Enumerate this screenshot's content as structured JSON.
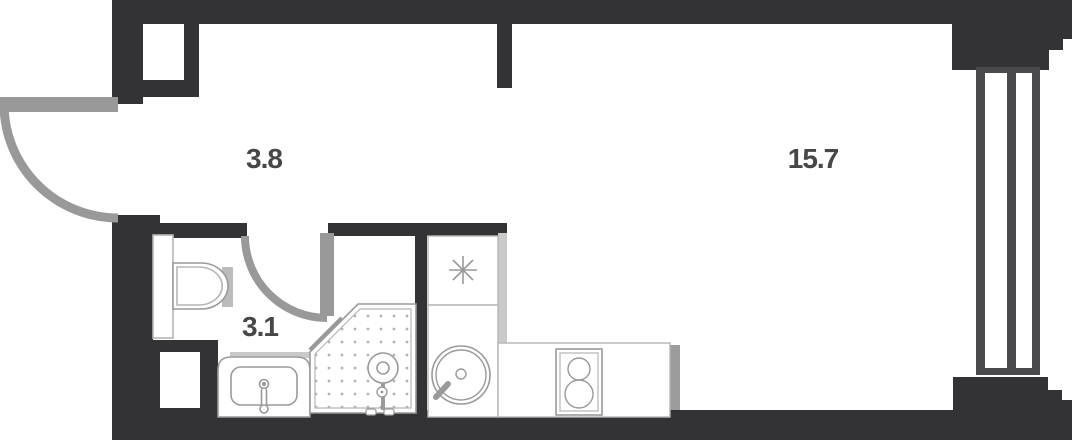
{
  "title": "Studio apartment floor plan",
  "rooms": [
    {
      "name": "hallway",
      "area": "3.8"
    },
    {
      "name": "living-room",
      "area": "15.7"
    },
    {
      "name": "bathroom",
      "area": "3.1"
    }
  ],
  "fixtures": [
    "entry-door",
    "bathroom-door",
    "toilet",
    "bathroom-sink",
    "shower",
    "kitchen-upper-cabinet",
    "vent-asterisk",
    "kitchen-round-sink",
    "stove-two-burner",
    "bay-window-mullions"
  ],
  "colors": {
    "wall": "#333336",
    "door": "#999999",
    "mullion": "#4a4a4d",
    "light": "#c9c9c9",
    "outline": "#9a9a9a",
    "thin": "#b5b5b5",
    "label": "#474747",
    "bg": "#ffffff"
  }
}
